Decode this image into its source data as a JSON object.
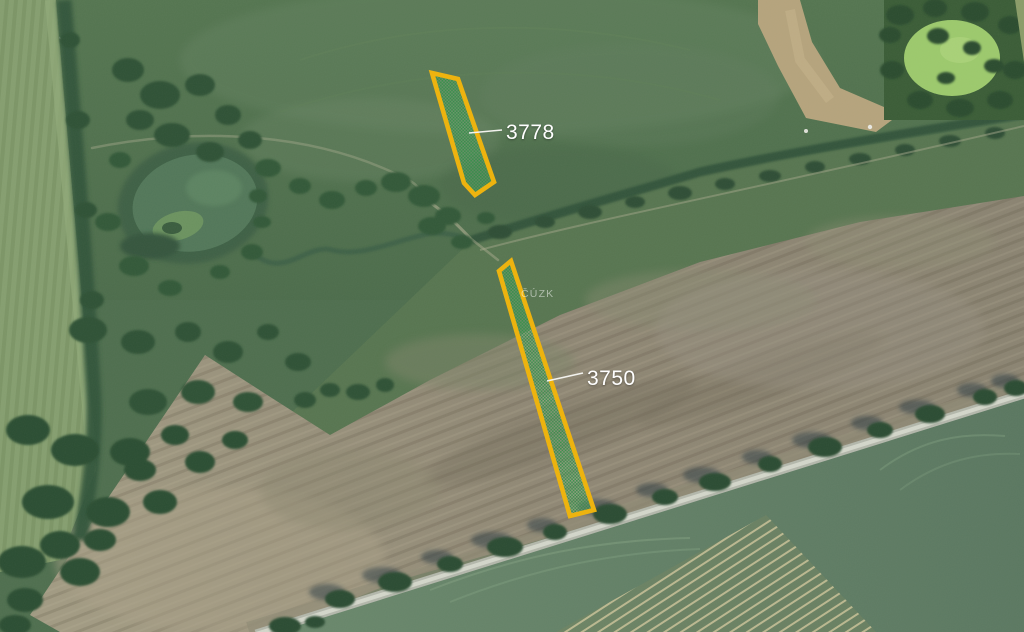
{
  "map": {
    "kind": "aerial-cadastral-view",
    "watermark": {
      "text": "ČÚZK",
      "x": 521,
      "y": 297
    },
    "style": {
      "parcel_stroke": "#edb30f",
      "parcel_fill": "#2f8f47",
      "parcel_fill_light": "#8cc48e",
      "label_color": "#ffffff",
      "leader_color": "#f2f2ee"
    },
    "parcels": [
      {
        "id": "3778",
        "label": "3778",
        "points": "432,73 458,79 494,182 475,195 464,183",
        "label_x": 506,
        "label_y": 139,
        "leader": {
          "x1": 469,
          "y1": 133,
          "x2": 502,
          "y2": 130
        }
      },
      {
        "id": "3750",
        "label": "3750",
        "points": "511,261 499,271 570,516 594,510",
        "label_x": 587,
        "label_y": 385,
        "leader": {
          "x1": 547,
          "y1": 381,
          "x2": 583,
          "y2": 373
        }
      }
    ]
  }
}
